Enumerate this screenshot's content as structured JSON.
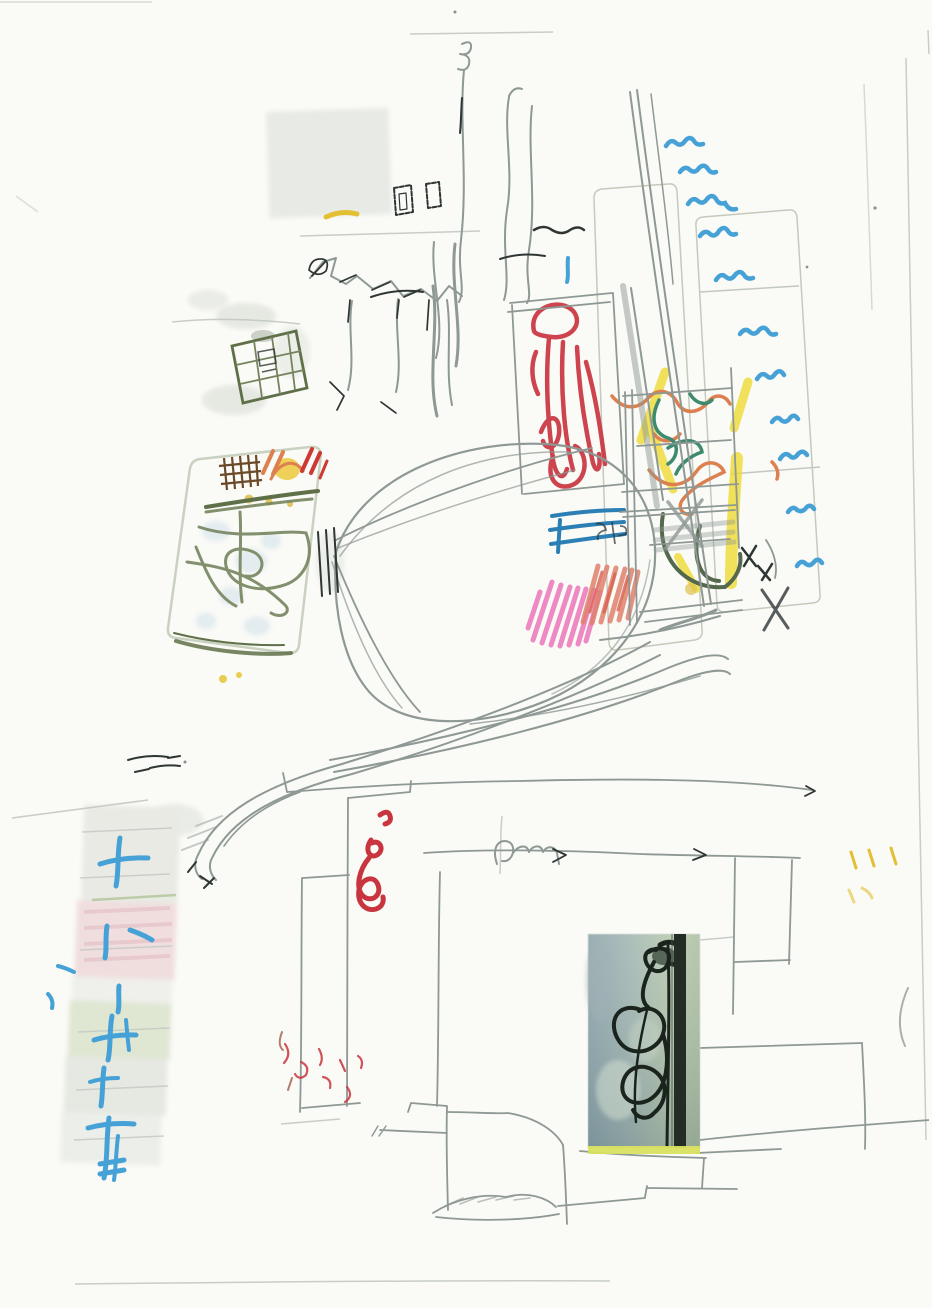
{
  "artwork": {
    "kind": "scanned mixed-media sketch",
    "description": "Child-like abstract pencil drawing with crayon colour blocks, washes, a taped colour strip and a pasted photograph of a black wire sculpture",
    "palette": {
      "paper": "#fafaf7",
      "paper_edge": "#d0d2cc",
      "pencil_light": "#c2c8c3",
      "pencil_soft": "#aab3ae",
      "pencil": "#8e9894",
      "pencil_dark": "#2e3634",
      "graphite_wash": "#e6e8e2",
      "wash_gray": "#e9eae4",
      "wash_pink": "#f0dede",
      "wash_green": "#dfe7d3",
      "wash_blue": "#cfe0e8",
      "card_fill": "#f2f5ec",
      "card_edge": "#c9d1c0",
      "panel_fill": "#f0f1ea",
      "panel_wash": "#e3e5df",
      "panel_edge": "#c5cabc",
      "crayon_blue": "#46a2d6",
      "crayon_blue_deep": "#2b7fb5",
      "blue_block": "#3f9ec9",
      "crayon_red": "#c9353f",
      "crayon_red_dull": "#cc3b33",
      "crayon_pink": "#ea75ba",
      "crayon_salmon": "#e0806c",
      "crayon_salmon_deep": "#d9604f",
      "crayon_orange": "#dd8050",
      "crayon_yellow": "#eeda32",
      "crayon_mustard": "#e3bf34",
      "crayon_teal": "#3d8a6e",
      "crayon_green_dark": "#55684e",
      "olive": "#75845e",
      "olive_dark": "#5f7048",
      "brown": "#6b4a2a",
      "brown_soft": "#a06048",
      "yellow_blob": "#ecc93e",
      "photo_sky_left": "#87a0a8",
      "photo_sky_mid": "#9fb4ae",
      "photo_green": "#b2c4a8",
      "photo_green_edge": "#a9bd9c",
      "photo_bar": "#242d25",
      "photo_wire": "#1b231d",
      "photo_strip": "#d9e060"
    },
    "elements": [
      {
        "name": "top-scribble-lines",
        "desc": "long wavy vertical pencil strokes, top centre"
      },
      {
        "name": "graphite-block",
        "desc": "soft grey wash rectangle, upper left"
      },
      {
        "name": "tiny-rectangles",
        "desc": "two small dashed pencil rectangles"
      },
      {
        "name": "rock-cluster",
        "desc": "jagged black and grey pencil facets, centre"
      },
      {
        "name": "olive-grid-box",
        "desc": "tilted olive grid square with graphite smudges"
      },
      {
        "name": "sketch-card",
        "desc": "tilted card with brown grid, orange/red ticks, yellow blob and olive maze"
      },
      {
        "name": "balloon",
        "desc": "large pencil teardrop pinched at the card edge"
      },
      {
        "name": "sweeping-curves",
        "desc": "two long pencil curve bundles crossing the page"
      },
      {
        "name": "red-figure-box",
        "desc": "pencil box holding a tangled red crayon figure"
      },
      {
        "name": "colour-panel",
        "desc": "panel of yellow bands, orange and teal squiggles, dark green curl"
      },
      {
        "name": "blue-crayon-block",
        "desc": "solid blue rectangle with pencil scribbles"
      },
      {
        "name": "pink-hatch",
        "desc": "magenta hatched patch beside a salmon hatched block"
      },
      {
        "name": "blue-squiggle-column",
        "desc": "column of blue crayon zigzags running down the right"
      },
      {
        "name": "tilted-panels",
        "desc": "two pale tilted panels behind the colour work"
      },
      {
        "name": "washed-strip",
        "desc": "vertical strip of grey/pink/green washes with blue crayon crosses, lower left"
      },
      {
        "name": "room-sketch",
        "desc": "loose pencil room structure, lower half"
      },
      {
        "name": "red-gi-scribble",
        "desc": "bold red looping scribble on the room sketch"
      },
      {
        "name": "pasted-photo",
        "desc": "photo of a black wire sculpture on blue-green ground with dark post and yellow lower strip"
      },
      {
        "name": "yellow-ticks",
        "desc": "small yellow dashes, right margin"
      },
      {
        "name": "page-creases",
        "desc": "faint scanner fold lines at right and bottom"
      }
    ]
  }
}
